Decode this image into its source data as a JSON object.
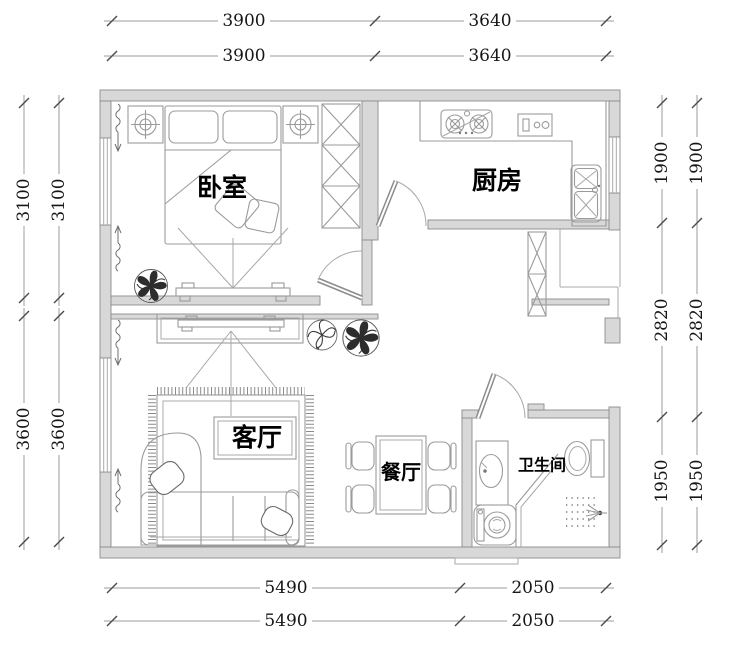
{
  "plan": {
    "rooms": {
      "bedroom": "卧室",
      "kitchen": "厨房",
      "living_room": "客厅",
      "dining_room": "餐厅",
      "bathroom": "卫生间"
    },
    "dims": {
      "top": [
        "3900",
        "3640"
      ],
      "left": [
        "3100",
        "3600"
      ],
      "right": [
        "1900",
        "2820",
        "1950"
      ],
      "bottom": [
        "5490",
        "2050"
      ]
    },
    "colors": {
      "paper": "#ffffff",
      "ink": "#161616",
      "drawing_line": "#9b9b9b",
      "wall_fill": "#d8d8d8",
      "wall_stroke": "#8c8c8c",
      "plant_dark": "#2d2d2d"
    }
  }
}
